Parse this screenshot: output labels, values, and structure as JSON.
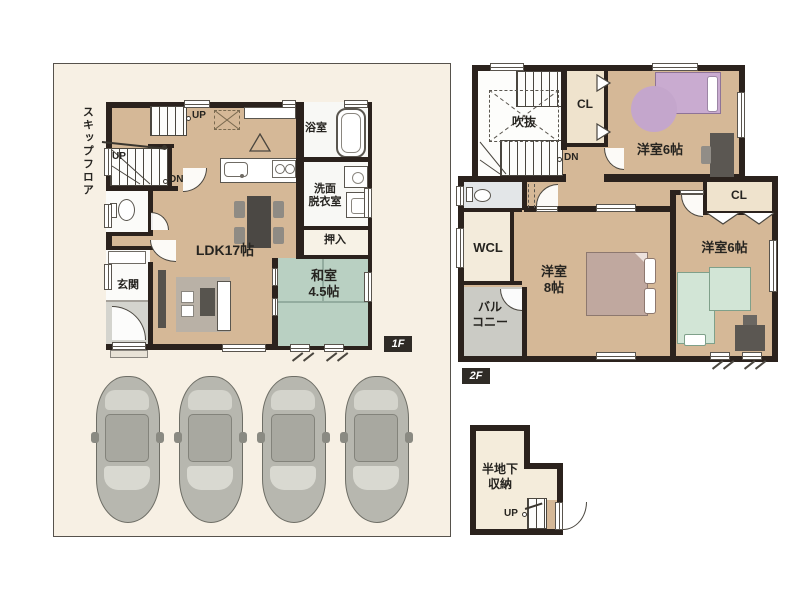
{
  "colors": {
    "floor_tan": "#d5b897",
    "tatami_green": "#b9d0c2",
    "wall_dark": "#2b221d",
    "site_bg": "#f7f0e4",
    "bed_purple": "#c9abd0",
    "bed_mauve": "#c0a89f",
    "bed_green": "#d2e5d6",
    "balcony_gray": "#cbcbc5",
    "badge_bg": "#2f2b26"
  },
  "floor1": {
    "badge": "1F",
    "skip_floor": "スキップフロア",
    "up_top": "UP",
    "up_mid": "UP",
    "down": "DN",
    "bath": "浴室",
    "washroom": "洗面\n脱衣室",
    "closet": "押入",
    "ldk": "LDK17帖",
    "tatami_room": "和室\n4.5帖",
    "entrance": "玄関"
  },
  "floor2": {
    "badge": "2F",
    "void": "吹抜",
    "down": "DN",
    "closet_top": "CL",
    "bedroom_top": "洋室6帖",
    "closet_right": "CL",
    "walk_in_closet": "WCL",
    "balcony": "バル\nコニー",
    "bedroom_main": "洋室\n8帖",
    "bedroom_bottom": "洋室6帖"
  },
  "basement": {
    "storage": "半地下\n収納",
    "up": "UP"
  }
}
